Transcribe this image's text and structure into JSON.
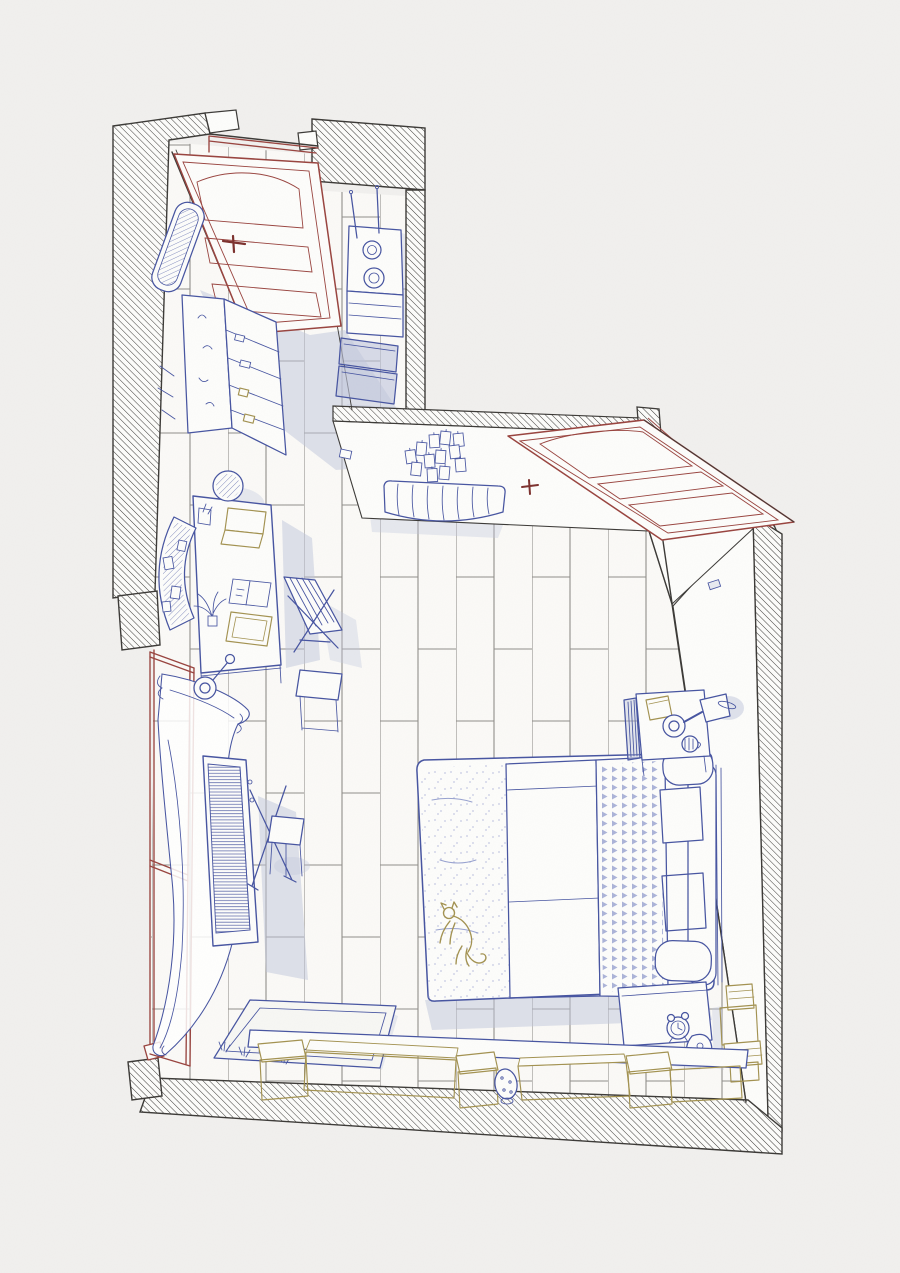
{
  "artwork": {
    "type": "hand-drawn axonometric cutaway illustration",
    "subject": "studio bedroom floor-plan drawing with bed, desk, kitchenette, keyboard piano, book rows and a cat on the bed",
    "visible_text": []
  },
  "palette": {
    "paper": "#f1f0ee",
    "floor": "#fbfaf7",
    "white_warm": "#fdfdfb",
    "ink": "#3a3835",
    "floor_line": "#8f8d89",
    "blue": "#4553a0",
    "blue_soft": "#96a0cf",
    "lavender": "#c0c5dc",
    "maroon": "#98423d",
    "maroon_dark": "#7b2f2c",
    "olive": "#a2914f"
  },
  "objects": [
    {
      "name": "hatched-walls",
      "color": "#3a3835"
    },
    {
      "name": "plank-floor",
      "color": "#8f8d89"
    },
    {
      "name": "entry-door-open",
      "color": "#98423d"
    },
    {
      "name": "interior-door-open",
      "color": "#98423d"
    },
    {
      "name": "window-frame",
      "color": "#98423d"
    },
    {
      "name": "sheer-curtain",
      "color": "#4553a0"
    },
    {
      "name": "kitchen-mirror",
      "color": "#4553a0"
    },
    {
      "name": "kitchen-shelf-column",
      "color": "#4553a0"
    },
    {
      "name": "corridor-stove-counter",
      "color": "#4553a0"
    },
    {
      "name": "storage-bins",
      "color": "#4553a0"
    },
    {
      "name": "photo-frame-cluster",
      "color": "#4553a0"
    },
    {
      "name": "radiator",
      "color": "#4553a0"
    },
    {
      "name": "desk",
      "color": "#4553a0"
    },
    {
      "name": "desk-chair",
      "color": "#4553a0"
    },
    {
      "name": "laptop",
      "color": "#a2914f"
    },
    {
      "name": "pegboard",
      "color": "#4553a0"
    },
    {
      "name": "folding-chair",
      "color": "#4553a0"
    },
    {
      "name": "side-table",
      "color": "#4553a0"
    },
    {
      "name": "keyboard-piano",
      "color": "#4553a0"
    },
    {
      "name": "stool",
      "color": "#4553a0"
    },
    {
      "name": "rug",
      "color": "#4553a0"
    },
    {
      "name": "bed",
      "color": "#4553a0"
    },
    {
      "name": "cat",
      "color": "#a2914f"
    },
    {
      "name": "checkered-blanket",
      "color": "#96a0cf"
    },
    {
      "name": "triangle-duvet",
      "color": "#96a0cf"
    },
    {
      "name": "pillows",
      "color": "#96a0cf"
    },
    {
      "name": "nightstand",
      "color": "#4553a0"
    },
    {
      "name": "reading-lamp",
      "color": "#4553a0"
    },
    {
      "name": "mug",
      "color": "#4553a0"
    },
    {
      "name": "alarm-clock",
      "color": "#4553a0"
    },
    {
      "name": "carafe",
      "color": "#4553a0"
    },
    {
      "name": "book-stacks",
      "color": "#a2914f"
    },
    {
      "name": "book-rows",
      "color": "#a2914f"
    },
    {
      "name": "spotted-vase",
      "color": "#4553a0"
    },
    {
      "name": "light-switch",
      "color": "#4553a0"
    }
  ]
}
